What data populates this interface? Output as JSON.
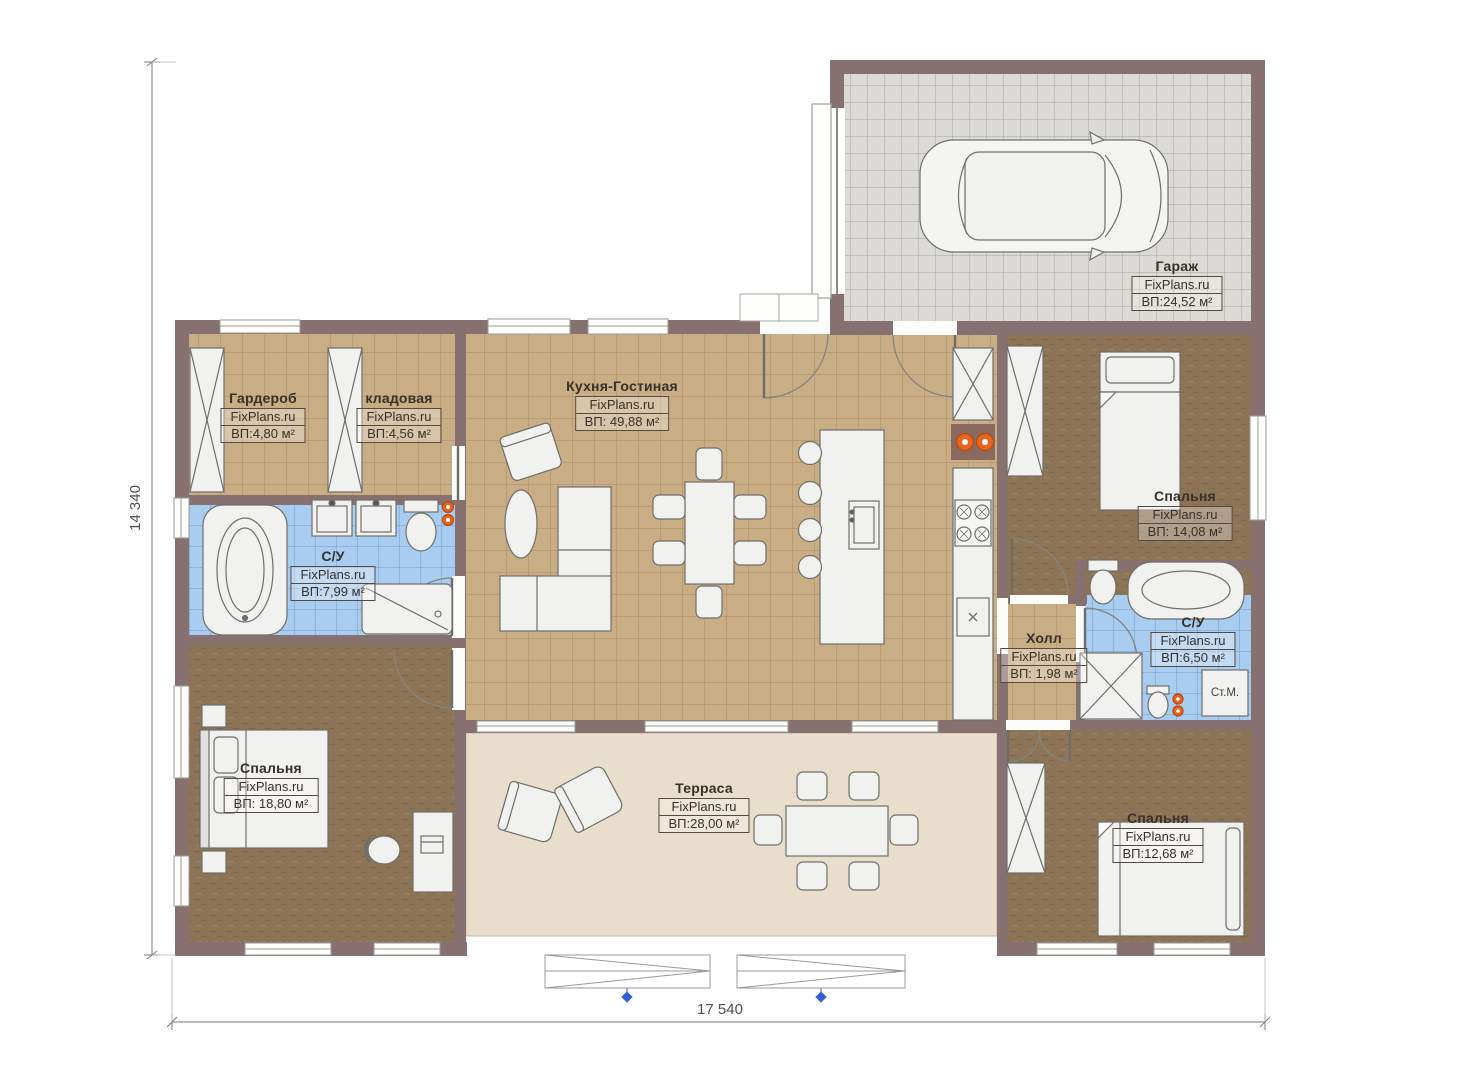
{
  "plan": {
    "dimensions": {
      "height_label": "14 340",
      "width_label": "17 540"
    },
    "rooms": {
      "garage": {
        "name": "Гараж",
        "site": "FixPlans.ru",
        "area": "ВП:24,52 м²"
      },
      "wardrobe": {
        "name": "Гардероб",
        "site": "FixPlans.ru",
        "area": "ВП:4,80 м²"
      },
      "storage": {
        "name": "кладовая",
        "site": "FixPlans.ru",
        "area": "ВП:4,56 м²"
      },
      "kitchen_living": {
        "name": "Кухня-Гостиная",
        "site": "FixPlans.ru",
        "area": "ВП: 49,88 м²"
      },
      "bathroom_left": {
        "name": "С/У",
        "site": "FixPlans.ru",
        "area": "ВП:7,99 м²"
      },
      "bedroom_top_right": {
        "name": "Спальня",
        "site": "FixPlans.ru",
        "area": "ВП: 14,08 м²"
      },
      "hall": {
        "name": "Холл",
        "site": "FixPlans.ru",
        "area": "ВП: 1,98 м²"
      },
      "bathroom_right": {
        "name": "С/У",
        "site": "FixPlans.ru",
        "area": "ВП:6,50 м²"
      },
      "bedroom_bottom_left": {
        "name": "Спальня",
        "site": "FixPlans.ru",
        "area": "ВП: 18,80 м²"
      },
      "terrace": {
        "name": "Терраса",
        "site": "FixPlans.ru",
        "area": "ВП:28,00 м²"
      },
      "bedroom_bottom_right": {
        "name": "Спальня",
        "site": "FixPlans.ru",
        "area": "ВП:12,68 м²"
      }
    },
    "annotations": {
      "washing_machine": "Ст.М."
    },
    "colors": {
      "wall": "#877170",
      "tile_floor": "#c9ad85",
      "wood_floor": "#8d7456",
      "bath_tile": "#a9cdf0",
      "terrace_floor": "#e8decb",
      "garage_floor": "#dbdad6",
      "radiator": "#e8631c",
      "marker_blue": "#2f5fd0"
    }
  }
}
